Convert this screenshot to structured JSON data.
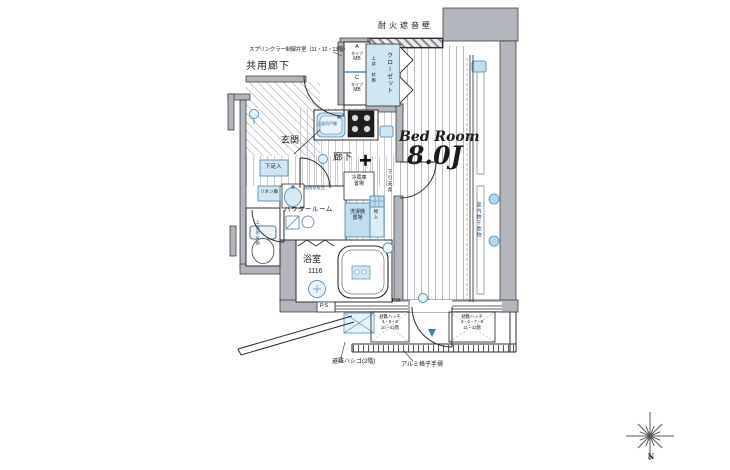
{
  "colors": {
    "wall_gray": "#b3b7bd",
    "fixture_blue": "#cfe6f3",
    "fixture_blue_deep": "#bfdff0",
    "blue_stroke": "#4a90c2",
    "accent_text": "#1f4e79",
    "line": "#2b2b2b"
  },
  "rooms": {
    "common_corridor": "共用廊下",
    "entrance": "玄関",
    "corridor": "廊下",
    "powder_room": "パウダールーム",
    "bathroom_name": "浴室",
    "bathroom_size": "1116",
    "bedroom_name": "Bed Room",
    "bedroom_size": "8.0J",
    "closet": "クローゼット"
  },
  "storage": {
    "closet_upper": "上部:枕棚",
    "shoe_box": "下足入",
    "linen": "リネン庫",
    "small_storage": "物入",
    "toilet_shelf": "上部吊戸棚",
    "kitchen_shelf": "上部吊戸棚"
  },
  "equipment": {
    "refrigerator_line1": "冷蔵庫",
    "refrigerator_line2": "置場",
    "washer_line1": "洗濯機",
    "washer_line2": "置場",
    "vanity": "洗面化粧台",
    "indoor_drying": "室内物干金物",
    "dropped_ceiling": "下り天井",
    "mb_a": [
      "A",
      "タイプ",
      "MB"
    ],
    "mb_c": [
      "C",
      "タイプ",
      "MB"
    ]
  },
  "notes": {
    "fire_wall": "耐火遮音壁",
    "sprinkler": "スプリンクラー制御弁室（11・12・13階）",
    "fix_window": "FIX",
    "pipe_space": "P.S",
    "hatch_left": [
      "避難ハッチ",
      "4・6・8",
      "10・12階"
    ],
    "hatch_right": [
      "避難ハッチ",
      "3・5・7・9",
      "11・13階"
    ],
    "ladder": "避難ハシゴ(2階)",
    "handrail": "アルミ格子手摺"
  },
  "compass": {
    "north": "N"
  }
}
